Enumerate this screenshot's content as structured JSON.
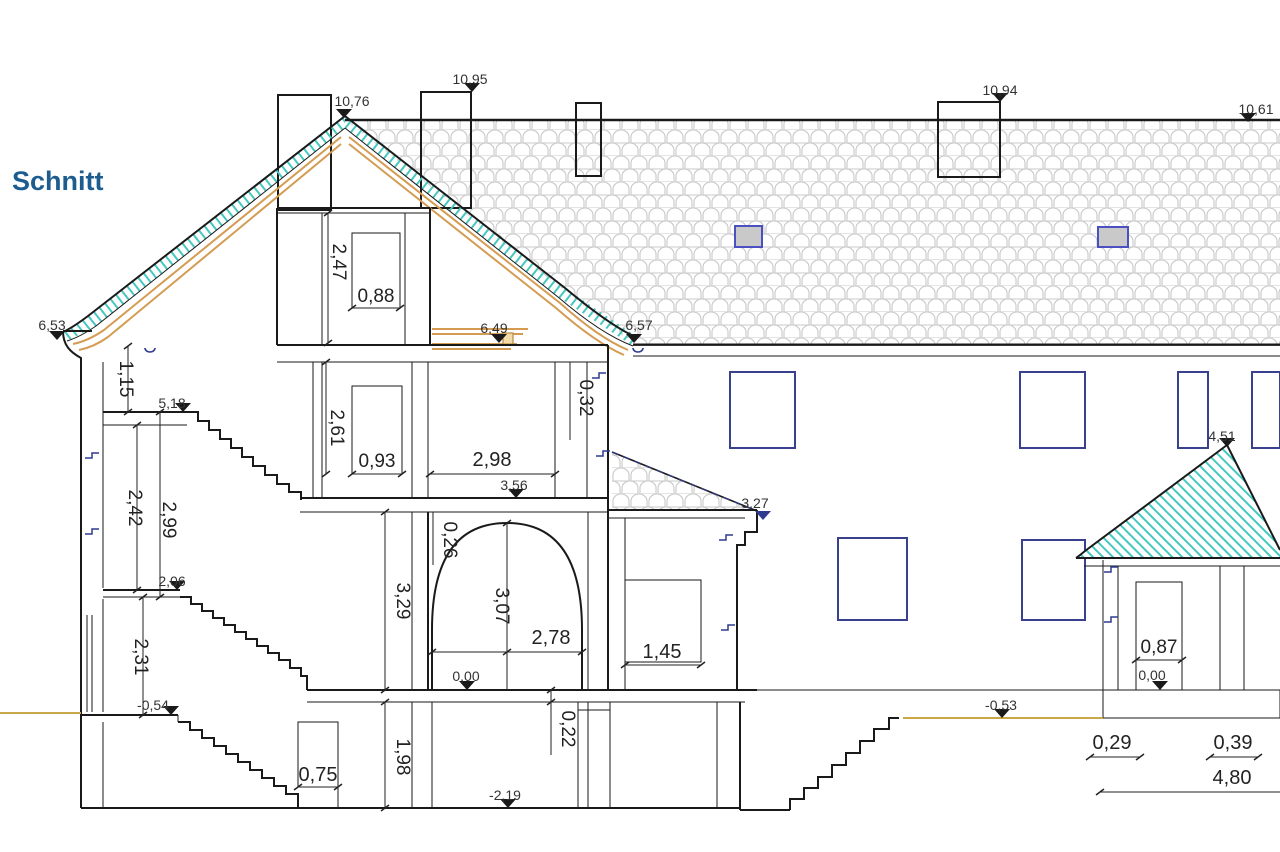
{
  "title": "Schnitt",
  "colors": {
    "title_blue": "#1d5c8f",
    "line_black": "#1a1a1a",
    "elevation_navy": "#2f3a8f",
    "window_blue": "#4a50c0",
    "roof_hatch_teal": "#45c8bf",
    "rafter_orange": "#d49c52",
    "tile_gray": "#c9c9c9",
    "ground_tan": "#c8a84b"
  },
  "labels": {
    "peak_gable": "10,76",
    "chimney_top": "10,95",
    "chimney_right_top": "10,94",
    "ridge_right": "10,61",
    "eave_left": "6,53",
    "attic_floor_level": "6,49",
    "eave_right": "6,57",
    "attic_height": "2,47",
    "attic_window_width": "0,88",
    "floor2_height": "2,61",
    "floor2_window_width": "0,93",
    "room_width": "2,98",
    "floor2_level": "3,56",
    "slab_dim": "0,32",
    "knee_wall_height": "1,15",
    "stair_top_level": "5,18",
    "stair_height_a": "2,42",
    "stair_height_b": "2,99",
    "landing_level": "2,06",
    "arch_offset": "0,26",
    "ground_room_height": "3,29",
    "arch_height": "3,07",
    "arch_width": "2,78",
    "annex_window_width": "1,45",
    "entrance_height": "2,31",
    "entrance_level": "-0,54",
    "ground_level": "0,00",
    "basement_door_width": "0,75",
    "basement_height": "1,98",
    "basement_slab_dim": "0,22",
    "basement_level": "-2,19",
    "annex_eave_level": "3,27",
    "pavilion_peak_level": "4,51",
    "pavilion_door_width": "0,87",
    "pavilion_ground_level": "0,00",
    "terrain_level": "-0,53",
    "plinth_dim_a": "0,29",
    "plinth_dim_b": "0,39",
    "plinth_width": "4,80"
  }
}
